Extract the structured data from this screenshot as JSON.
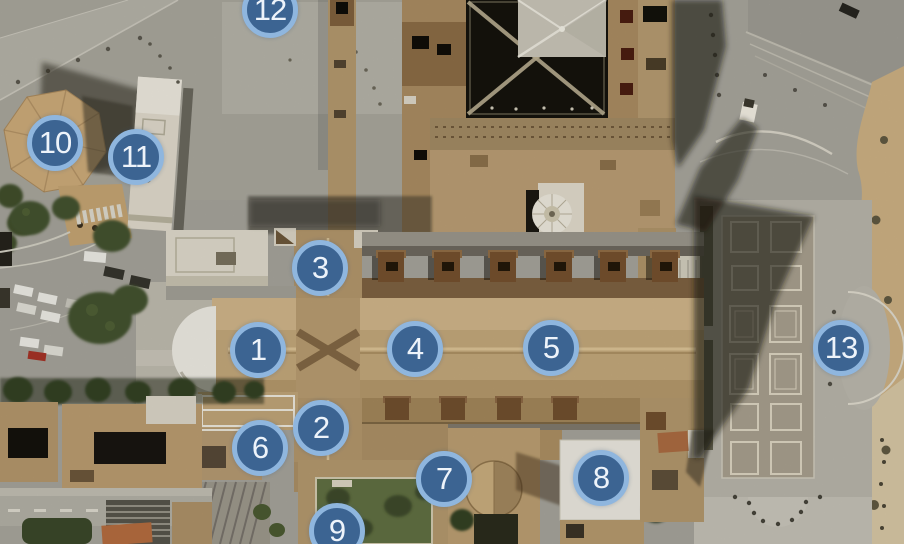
{
  "map": {
    "view": "satellite-aerial-basilica-complex",
    "markers": [
      {
        "label": "1",
        "x": 258,
        "y": 350
      },
      {
        "label": "2",
        "x": 321,
        "y": 428
      },
      {
        "label": "3",
        "x": 320,
        "y": 268
      },
      {
        "label": "4",
        "x": 415,
        "y": 349
      },
      {
        "label": "5",
        "x": 551,
        "y": 348
      },
      {
        "label": "6",
        "x": 260,
        "y": 448
      },
      {
        "label": "7",
        "x": 444,
        "y": 479
      },
      {
        "label": "8",
        "x": 601,
        "y": 478
      },
      {
        "label": "9",
        "x": 337,
        "y": 531
      },
      {
        "label": "10",
        "x": 55,
        "y": 143
      },
      {
        "label": "11",
        "x": 136,
        "y": 157
      },
      {
        "label": "12",
        "x": 270,
        "y": 10
      },
      {
        "label": "13",
        "x": 841,
        "y": 348
      }
    ],
    "marker_style": {
      "fill": "#3c6492",
      "ring": "#8fb6de",
      "text_color": "#edf3fa"
    }
  }
}
